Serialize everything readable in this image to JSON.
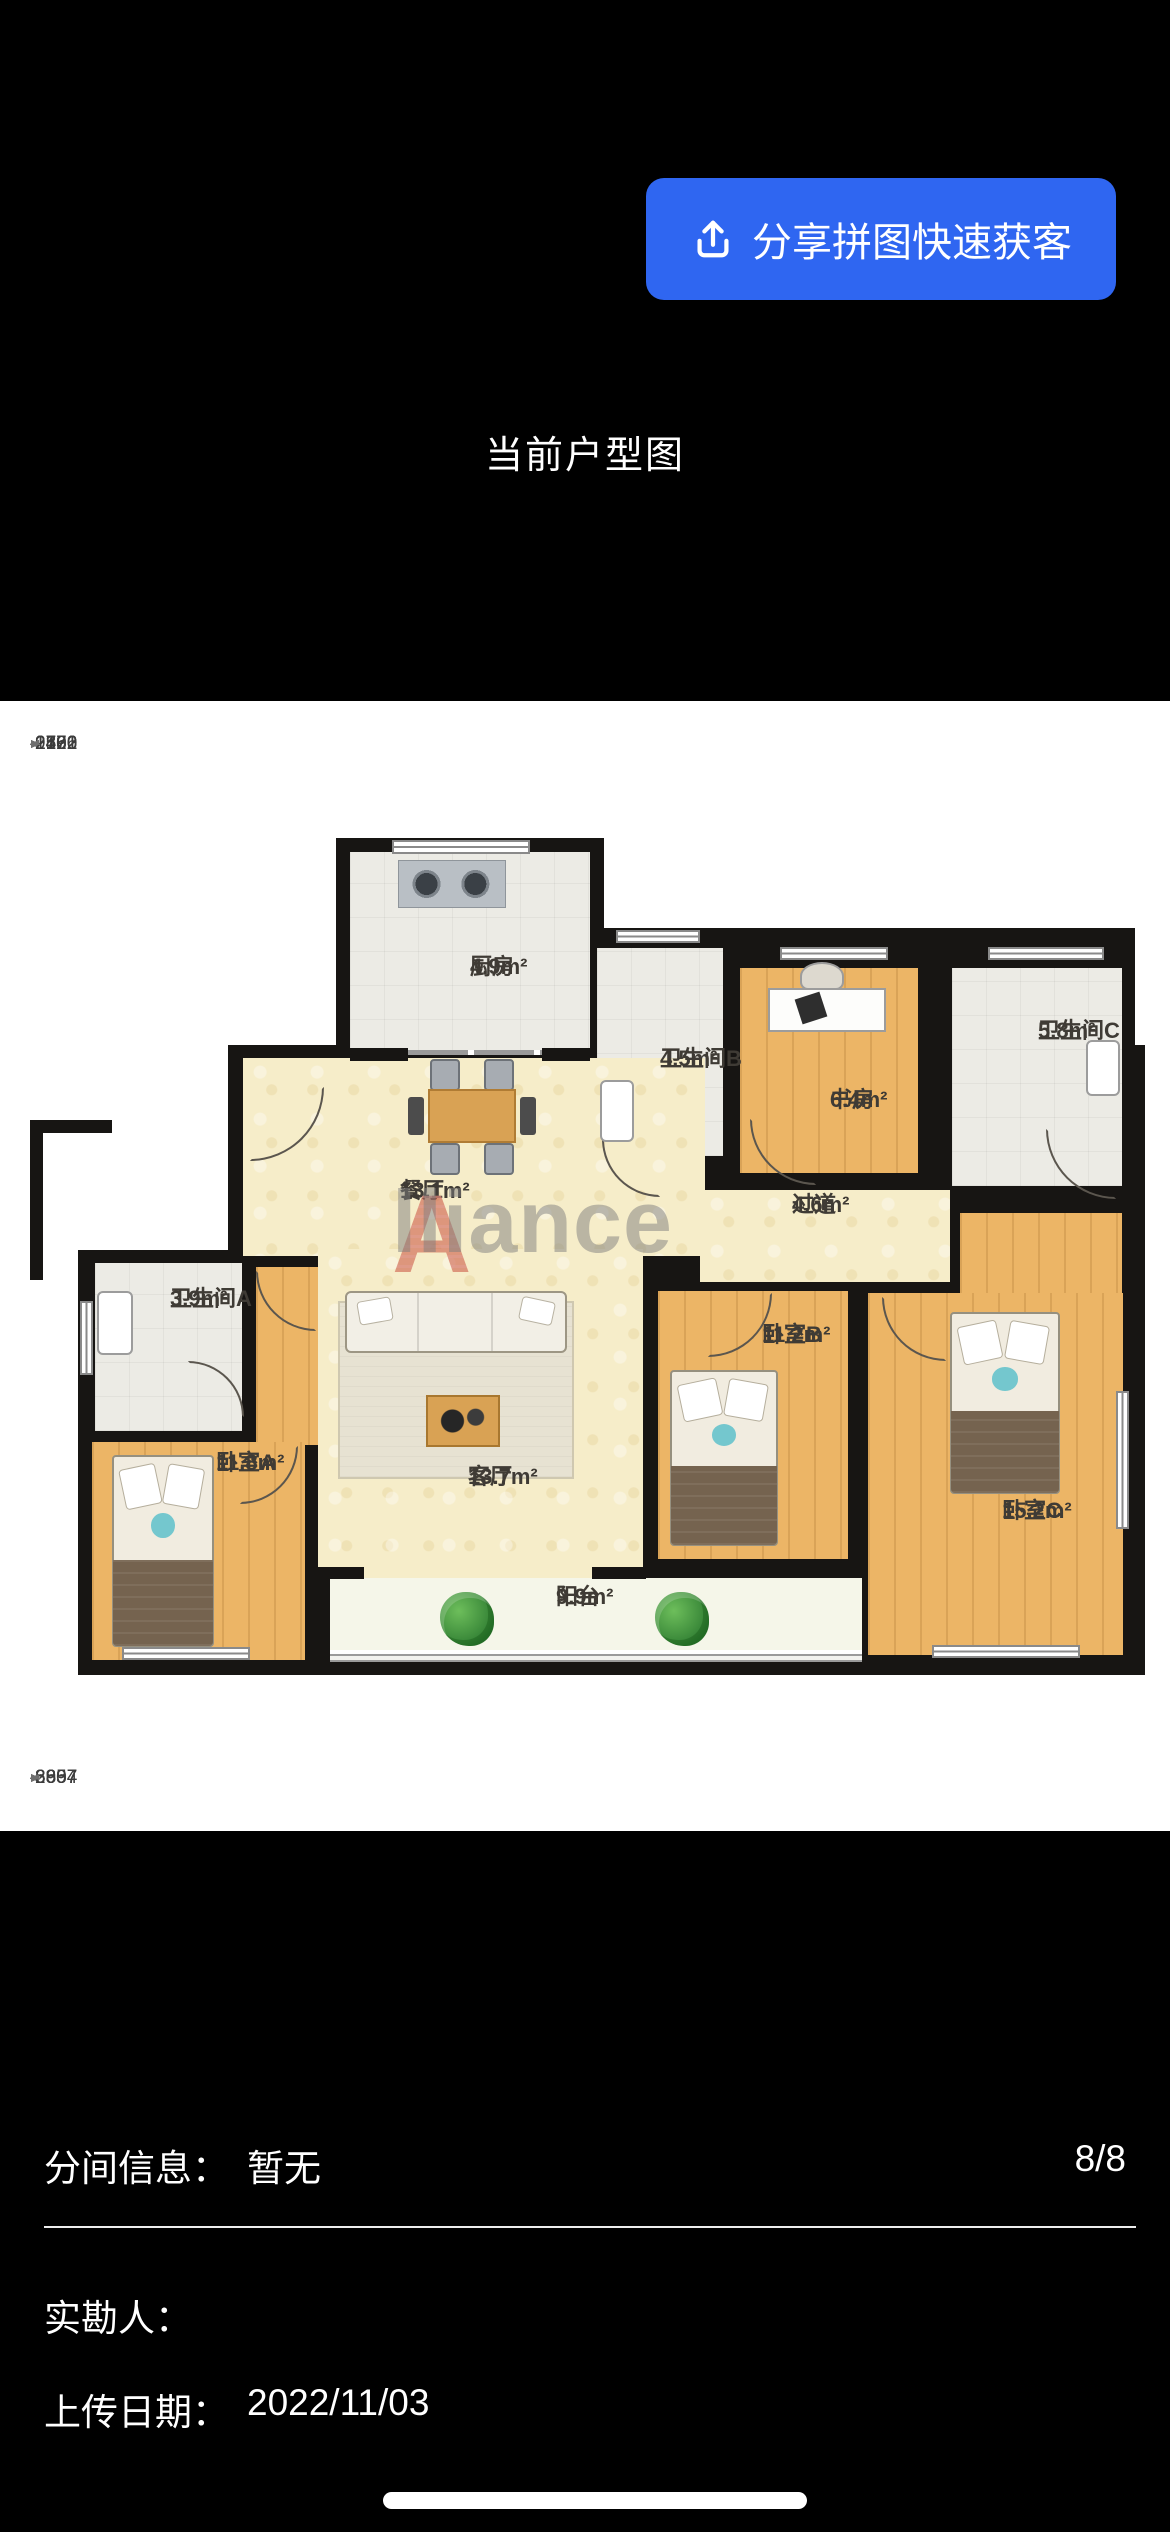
{
  "header": {
    "share_button": "分享拼图快速获客",
    "title": "当前户型图"
  },
  "floorplan": {
    "top_dims": [
      "979",
      "1402",
      "2130",
      "2576",
      "1761",
      "2822",
      "2161"
    ],
    "bottom_dims": [
      "863",
      "2907",
      "6857",
      "3394"
    ],
    "watermark": {
      "first": "A",
      "rest": "lliance"
    },
    "rooms": {
      "kitchen": {
        "name": "厨房",
        "area": "4.9m²"
      },
      "bathB": {
        "name": "卫生间B",
        "area": "4.5m²"
      },
      "study": {
        "name": "书房",
        "area": "6.4m²"
      },
      "bathC": {
        "name": "卫生间C",
        "area": "5.8m²"
      },
      "dining": {
        "name": "餐厅",
        "area": "13.1m²"
      },
      "hall": {
        "name": "过道",
        "area": "4.6m²"
      },
      "bathA": {
        "name": "卫生间A",
        "area": "3.9m²"
      },
      "bedA": {
        "name": "卧室A",
        "area": "11.8m²"
      },
      "living": {
        "name": "客厅",
        "area": "13.7m²"
      },
      "bedB": {
        "name": "卧室B",
        "area": "11.2m²"
      },
      "bedC": {
        "name": "卧室C",
        "area": "15.2m²"
      },
      "balcony": {
        "name": "阳台",
        "area": "9.9m²"
      }
    }
  },
  "info": {
    "partition_label": "分间信息：",
    "partition_value": "暂无",
    "page_indicator": "8/8",
    "surveyor_label": "实勘人：",
    "surveyor_value": "",
    "upload_label": "上传日期：",
    "upload_value": "2022/11/03"
  },
  "colors": {
    "accent_blue": "#2F66F1",
    "wall": "#171513",
    "floor_wood": "#ECB566",
    "floor_cream": "#F6EDC9",
    "floor_tile": "#ECEBE5",
    "floor_balcony": "#F5F6E9",
    "watermark_red": "#C94F3D",
    "dimension_line": "#6f6f6f"
  }
}
